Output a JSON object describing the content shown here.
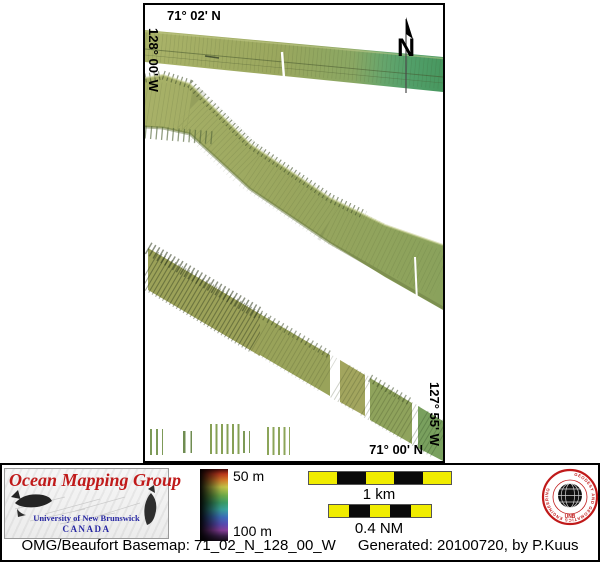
{
  "map": {
    "top_latitude": "71° 02' N",
    "left_longitude": "128° 00' W",
    "right_longitude": "127° 55' W",
    "bottom_latitude": "71° 00' N",
    "north_arrow_label": "N"
  },
  "legend": {
    "depth_top": "50 m",
    "depth_bottom": "100 m",
    "scale_km": "1 km",
    "scale_nm": "0.4 NM"
  },
  "branding": {
    "group_name": "Ocean Mapping Group",
    "university": "University of New Brunswick",
    "country": "CANADA",
    "seal_ring_text": "GEODESY AND GEOMATICS ENGINEERING",
    "seal_bottom_text": "UNB"
  },
  "footer": {
    "basemap_text": "OMG/Beaufort Basemap: 71_02_N_128_00_W",
    "generated_text": "Generated: 20100720, by P.Kuus"
  },
  "colors": {
    "swath_olive": "#9aa65f",
    "swath_green": "#4a9a67",
    "scalebar_yellow": "#f0ec00",
    "brand_red": "#c01a1a",
    "brand_blue": "#2929a3",
    "seal_red": "#c01a1a"
  }
}
